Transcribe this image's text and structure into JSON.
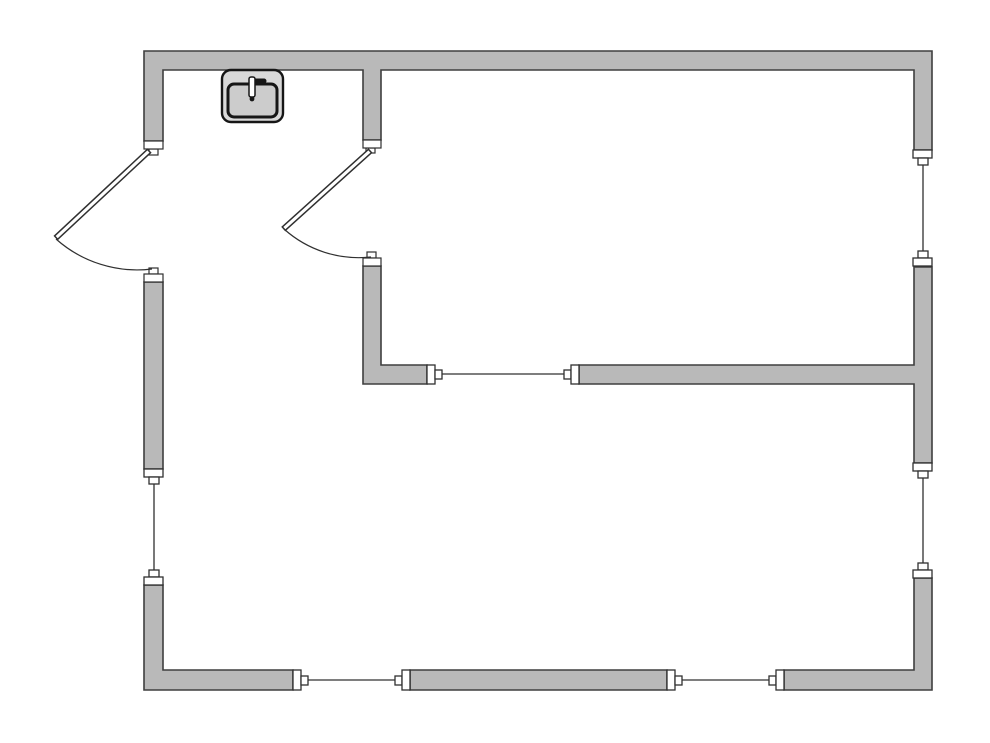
{
  "diagram": {
    "type": "floor-plan",
    "canvas": {
      "width": 990,
      "height": 743
    },
    "colors": {
      "background": "#ffffff",
      "wall_fill": "#b9b9b9",
      "wall_stroke": "#3f3f3f",
      "opening_fill": "#ffffff",
      "opening_stroke": "#303030",
      "fixture_fill": "#d9d9d9",
      "fixture_basin_fill": "#cccccc",
      "fixture_stroke": "#161616"
    },
    "walls": [
      {
        "name": "perimeter-top-wall",
        "path": "M144,51 H932 V150 H914 V70 H381 V140 H363 V70 H163 V141 H144 Z"
      },
      {
        "name": "left-wall-middle-segment",
        "path": "M144,282 H163 V469 H144 Z"
      },
      {
        "name": "left-wall-bottom-corner",
        "path": "M144,585 H163 V670 H293 V690 H144 Z"
      },
      {
        "name": "bottom-wall-middle-segment",
        "path": "M410,670 H667 V690 H410 Z"
      },
      {
        "name": "bottom-wall-right-corner",
        "path": "M784,670 H914 V578 H932 V690 H784 Z"
      },
      {
        "name": "right-wall-middle-segment",
        "path": "M914,267 H932 V463 H914 V384 H579 V365 H914 Z"
      },
      {
        "name": "interior-partition-ell",
        "path": "M363,266 H381 V365 H427 V384 H363 Z"
      }
    ],
    "windows": [
      {
        "name": "left-wall-window",
        "frames": [
          [
            144,
            469,
            19,
            8
          ],
          [
            149,
            477,
            10,
            7
          ],
          [
            149,
            570,
            10,
            7
          ],
          [
            144,
            577,
            19,
            8
          ]
        ],
        "glass": [
          154,
          484,
          154,
          570
        ]
      },
      {
        "name": "right-wall-upper-window",
        "frames": [
          [
            913,
            150,
            19,
            8
          ],
          [
            918,
            158,
            10,
            7
          ],
          [
            918,
            251,
            10,
            7
          ],
          [
            913,
            258,
            19,
            8
          ]
        ],
        "glass": [
          923,
          165,
          923,
          251
        ]
      },
      {
        "name": "right-wall-lower-window",
        "frames": [
          [
            913,
            463,
            19,
            8
          ],
          [
            918,
            471,
            10,
            7
          ],
          [
            918,
            563,
            10,
            7
          ],
          [
            913,
            570,
            19,
            8
          ]
        ],
        "glass": [
          923,
          478,
          923,
          563
        ]
      },
      {
        "name": "bottom-wall-left-window",
        "frames": [
          [
            293,
            670,
            8,
            20
          ],
          [
            301,
            676,
            7,
            9
          ],
          [
            395,
            676,
            7,
            9
          ],
          [
            402,
            670,
            8,
            20
          ]
        ],
        "glass": [
          308,
          680,
          395,
          680
        ]
      },
      {
        "name": "bottom-wall-right-window",
        "frames": [
          [
            667,
            670,
            8,
            20
          ],
          [
            675,
            676,
            7,
            9
          ],
          [
            769,
            676,
            7,
            9
          ],
          [
            776,
            670,
            8,
            20
          ]
        ],
        "glass": [
          682,
          680,
          769,
          680
        ]
      },
      {
        "name": "interior-wall-window",
        "frames": [
          [
            427,
            365,
            8,
            19
          ],
          [
            435,
            370,
            7,
            9
          ],
          [
            564,
            370,
            7,
            9
          ],
          [
            571,
            365,
            8,
            19
          ]
        ],
        "glass": [
          442,
          374,
          564,
          374
        ]
      }
    ],
    "doors": [
      {
        "name": "entry-door",
        "leaf": {
          "hinge": [
            149,
            151
          ],
          "angle_deg": 137,
          "length": 127,
          "width": 4.6
        },
        "swing_arc": "M56,239 A122,122 0 0 0 152,269",
        "stops": [
          {
            "cap": [
              144,
              141,
              19,
              8
            ],
            "tab": [
              149,
              149,
              9,
              6
            ]
          },
          {
            "cap": [
              144,
              274,
              19,
              8
            ],
            "tab": [
              149,
              268,
              9,
              6
            ]
          }
        ]
      },
      {
        "name": "interior-door",
        "leaf": {
          "hinge": [
            370,
            151
          ],
          "angle_deg": 138,
          "length": 116,
          "width": 4.6
        },
        "swing_arc": "M284,229 A112,112 0 0 0 371,257",
        "stops": [
          {
            "cap": [
              363,
              140,
              18,
              8
            ],
            "tab": [
              366,
              148,
              9,
              5
            ]
          },
          {
            "cap": [
              363,
              258,
              18,
              8
            ],
            "tab": [
              367,
              252,
              9,
              6
            ]
          }
        ]
      }
    ],
    "fixtures": [
      {
        "name": "kitchen-sink",
        "body": [
          222,
          70,
          61,
          52,
          9
        ],
        "basin": [
          228,
          84,
          49,
          33,
          6
        ],
        "faucet_stem": [
          249,
          77,
          6,
          20
        ],
        "faucet_spout": [
          254,
          81,
          264,
          81
        ],
        "drain_center": [
          252,
          99
        ],
        "drain_radius": 2.4
      }
    ]
  }
}
